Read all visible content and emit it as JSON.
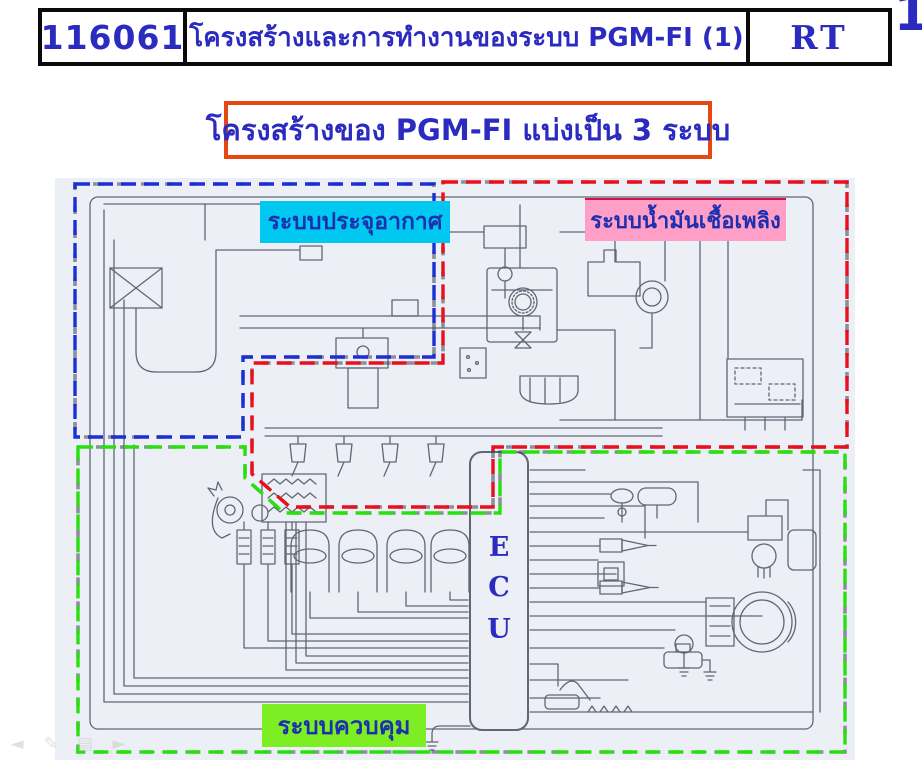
{
  "page": {
    "number": "1"
  },
  "header": {
    "code": "116061",
    "title": "โครงสร้างและการทำงานของระบบ PGM-FI (1)",
    "badge": "RT"
  },
  "heading": {
    "text": "โครงสร้างของ PGM-FI แบ่งเป็น 3 ระบบ"
  },
  "diagram": {
    "regions": [
      {
        "id": "air",
        "label": "ระบบประจุอากาศ"
      },
      {
        "id": "fuel",
        "label": "ระบบน้ำมันเชื้อเพลิง"
      },
      {
        "id": "control",
        "label": "ระบบควบคุม"
      }
    ],
    "ecu": {
      "letters": [
        "E",
        "C",
        "U"
      ]
    }
  },
  "nav": {
    "icons": [
      {
        "name": "previous-slide",
        "glyph": "◄"
      },
      {
        "name": "pen-tool",
        "glyph": "✎"
      },
      {
        "name": "slide-menu",
        "glyph": "▤"
      },
      {
        "name": "next-slide",
        "glyph": "►"
      }
    ]
  },
  "theme": {
    "ink_blue": "#2b2bbf",
    "scan_bg": "#edeff7",
    "line": "#5f6674",
    "air_region": "#1c2fd4",
    "fuel_region": "#e8101c",
    "control_region": "#28e00e",
    "air_label_bg": "#00c8f0",
    "fuel_label_bg": "#ff9fc8",
    "control_label_bg": "#7dee24",
    "label_text": "#1c2fae",
    "heading_border": "#e64813"
  }
}
